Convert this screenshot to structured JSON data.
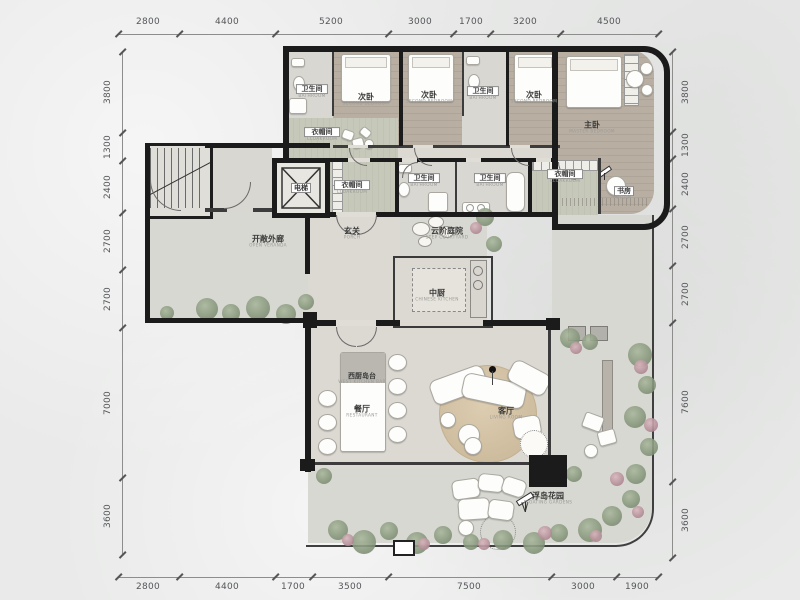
{
  "dimensions": {
    "top": [
      "2800",
      "4400",
      "5200",
      "3000",
      "1700",
      "3200",
      "4500"
    ],
    "bottom": [
      "2800",
      "4400",
      "1700",
      "3500",
      "7500",
      "3000",
      "1900"
    ],
    "left": [
      "3800",
      "1300",
      "2400",
      "2700",
      "2700",
      "7000",
      "3600"
    ],
    "right": [
      "3800",
      "1300",
      "2400",
      "2700",
      "2700",
      "7600",
      "3600"
    ]
  },
  "rooms": {
    "bathroom1": {
      "zh": "卫生间",
      "en": "BATHROOM"
    },
    "bedroom1": {
      "zh": "次卧",
      "en": "SECOND BEDROOM"
    },
    "bedroom2": {
      "zh": "次卧",
      "en": "SECOND BEDROOM"
    },
    "bathroom2": {
      "zh": "卫生间",
      "en": "BATHROOM"
    },
    "bedroom3": {
      "zh": "次卧",
      "en": "SECOND BEDROOM"
    },
    "master": {
      "zh": "主卧",
      "en": "MASTER BEDROOM"
    },
    "cloak1": {
      "zh": "衣帽间",
      "en": "CLOAKROOM"
    },
    "cloak2": {
      "zh": "衣帽间",
      "en": "CLOAKROOM"
    },
    "bath3": {
      "zh": "卫生间",
      "en": "BATHROOM"
    },
    "bath4": {
      "zh": "卫生间",
      "en": "BATHROOM"
    },
    "cloak3": {
      "zh": "衣帽间",
      "en": "CLOAKROOM"
    },
    "study": {
      "zh": "书房",
      "en": "STUDY"
    },
    "elevator": {
      "zh": "电梯",
      "en": ""
    },
    "veranda": {
      "zh": "开敞外廊",
      "en": "OPEN VERANDA"
    },
    "porch": {
      "zh": "玄关",
      "en": "PORCH"
    },
    "courtyard": {
      "zh": "云阶庭院",
      "en": "STEP COURTYARD"
    },
    "kitchen": {
      "zh": "中厨",
      "en": "CHINESE KITCHEN"
    },
    "island": {
      "zh": "西厨岛台",
      "en": "WEST KITCHEN BAR"
    },
    "dining": {
      "zh": "餐厅",
      "en": "RESTAURANT"
    },
    "living": {
      "zh": "客厅",
      "en": "LIVING ROOM"
    },
    "garden": {
      "zh": "浮岛花园",
      "en": "FLOATING GARDENS"
    }
  },
  "colors": {
    "wall": "#1b1b1b",
    "woodFloor": "#b8afa2",
    "tileFloor": "#d9d7d1",
    "cloakFloor": "#c6c8b9",
    "plantGreen": "#7d8e73",
    "flowerPink": "#ad8792",
    "rug": "#d7c6a9",
    "paper": "#e9eae9"
  }
}
